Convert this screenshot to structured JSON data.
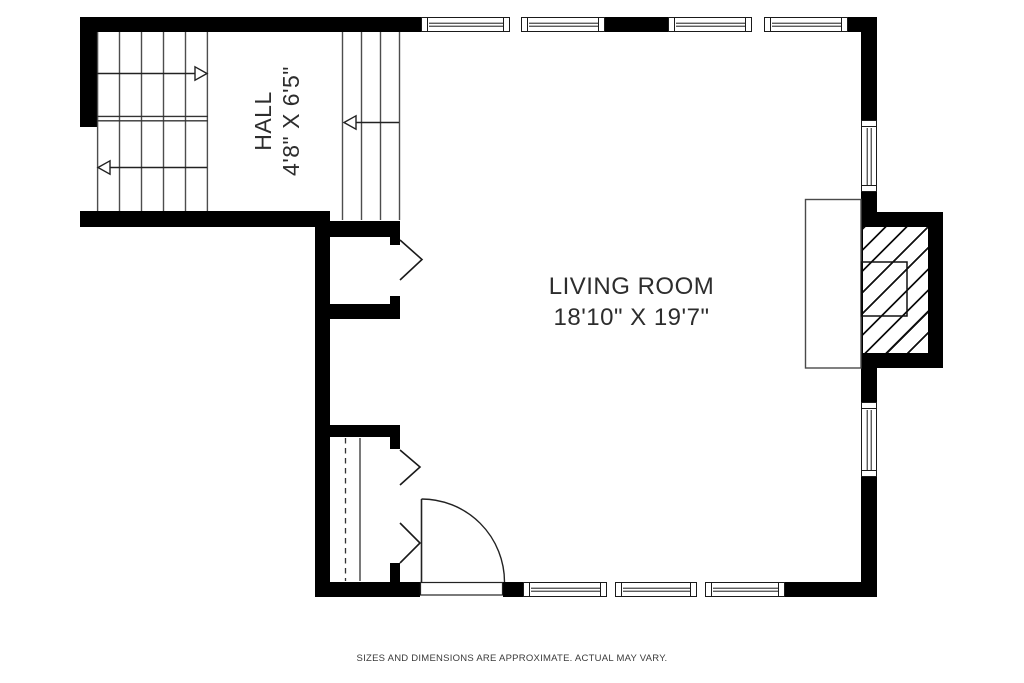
{
  "floor_plan": {
    "hall": {
      "label": "HALL",
      "dimensions": "4'8\" X 6'5\""
    },
    "living_room": {
      "label": "LIVING ROOM",
      "dimensions": "18'10\" X 19'7\""
    },
    "disclaimer": "SIZES AND DIMENSIONS ARE APPROXIMATE. ACTUAL MAY VARY.",
    "colors": {
      "wall": "#000000",
      "stair_line": "#4d4d4d",
      "symbol_line": "#1a1a1a",
      "text": "#2d2d2d",
      "background": "#ffffff"
    }
  }
}
